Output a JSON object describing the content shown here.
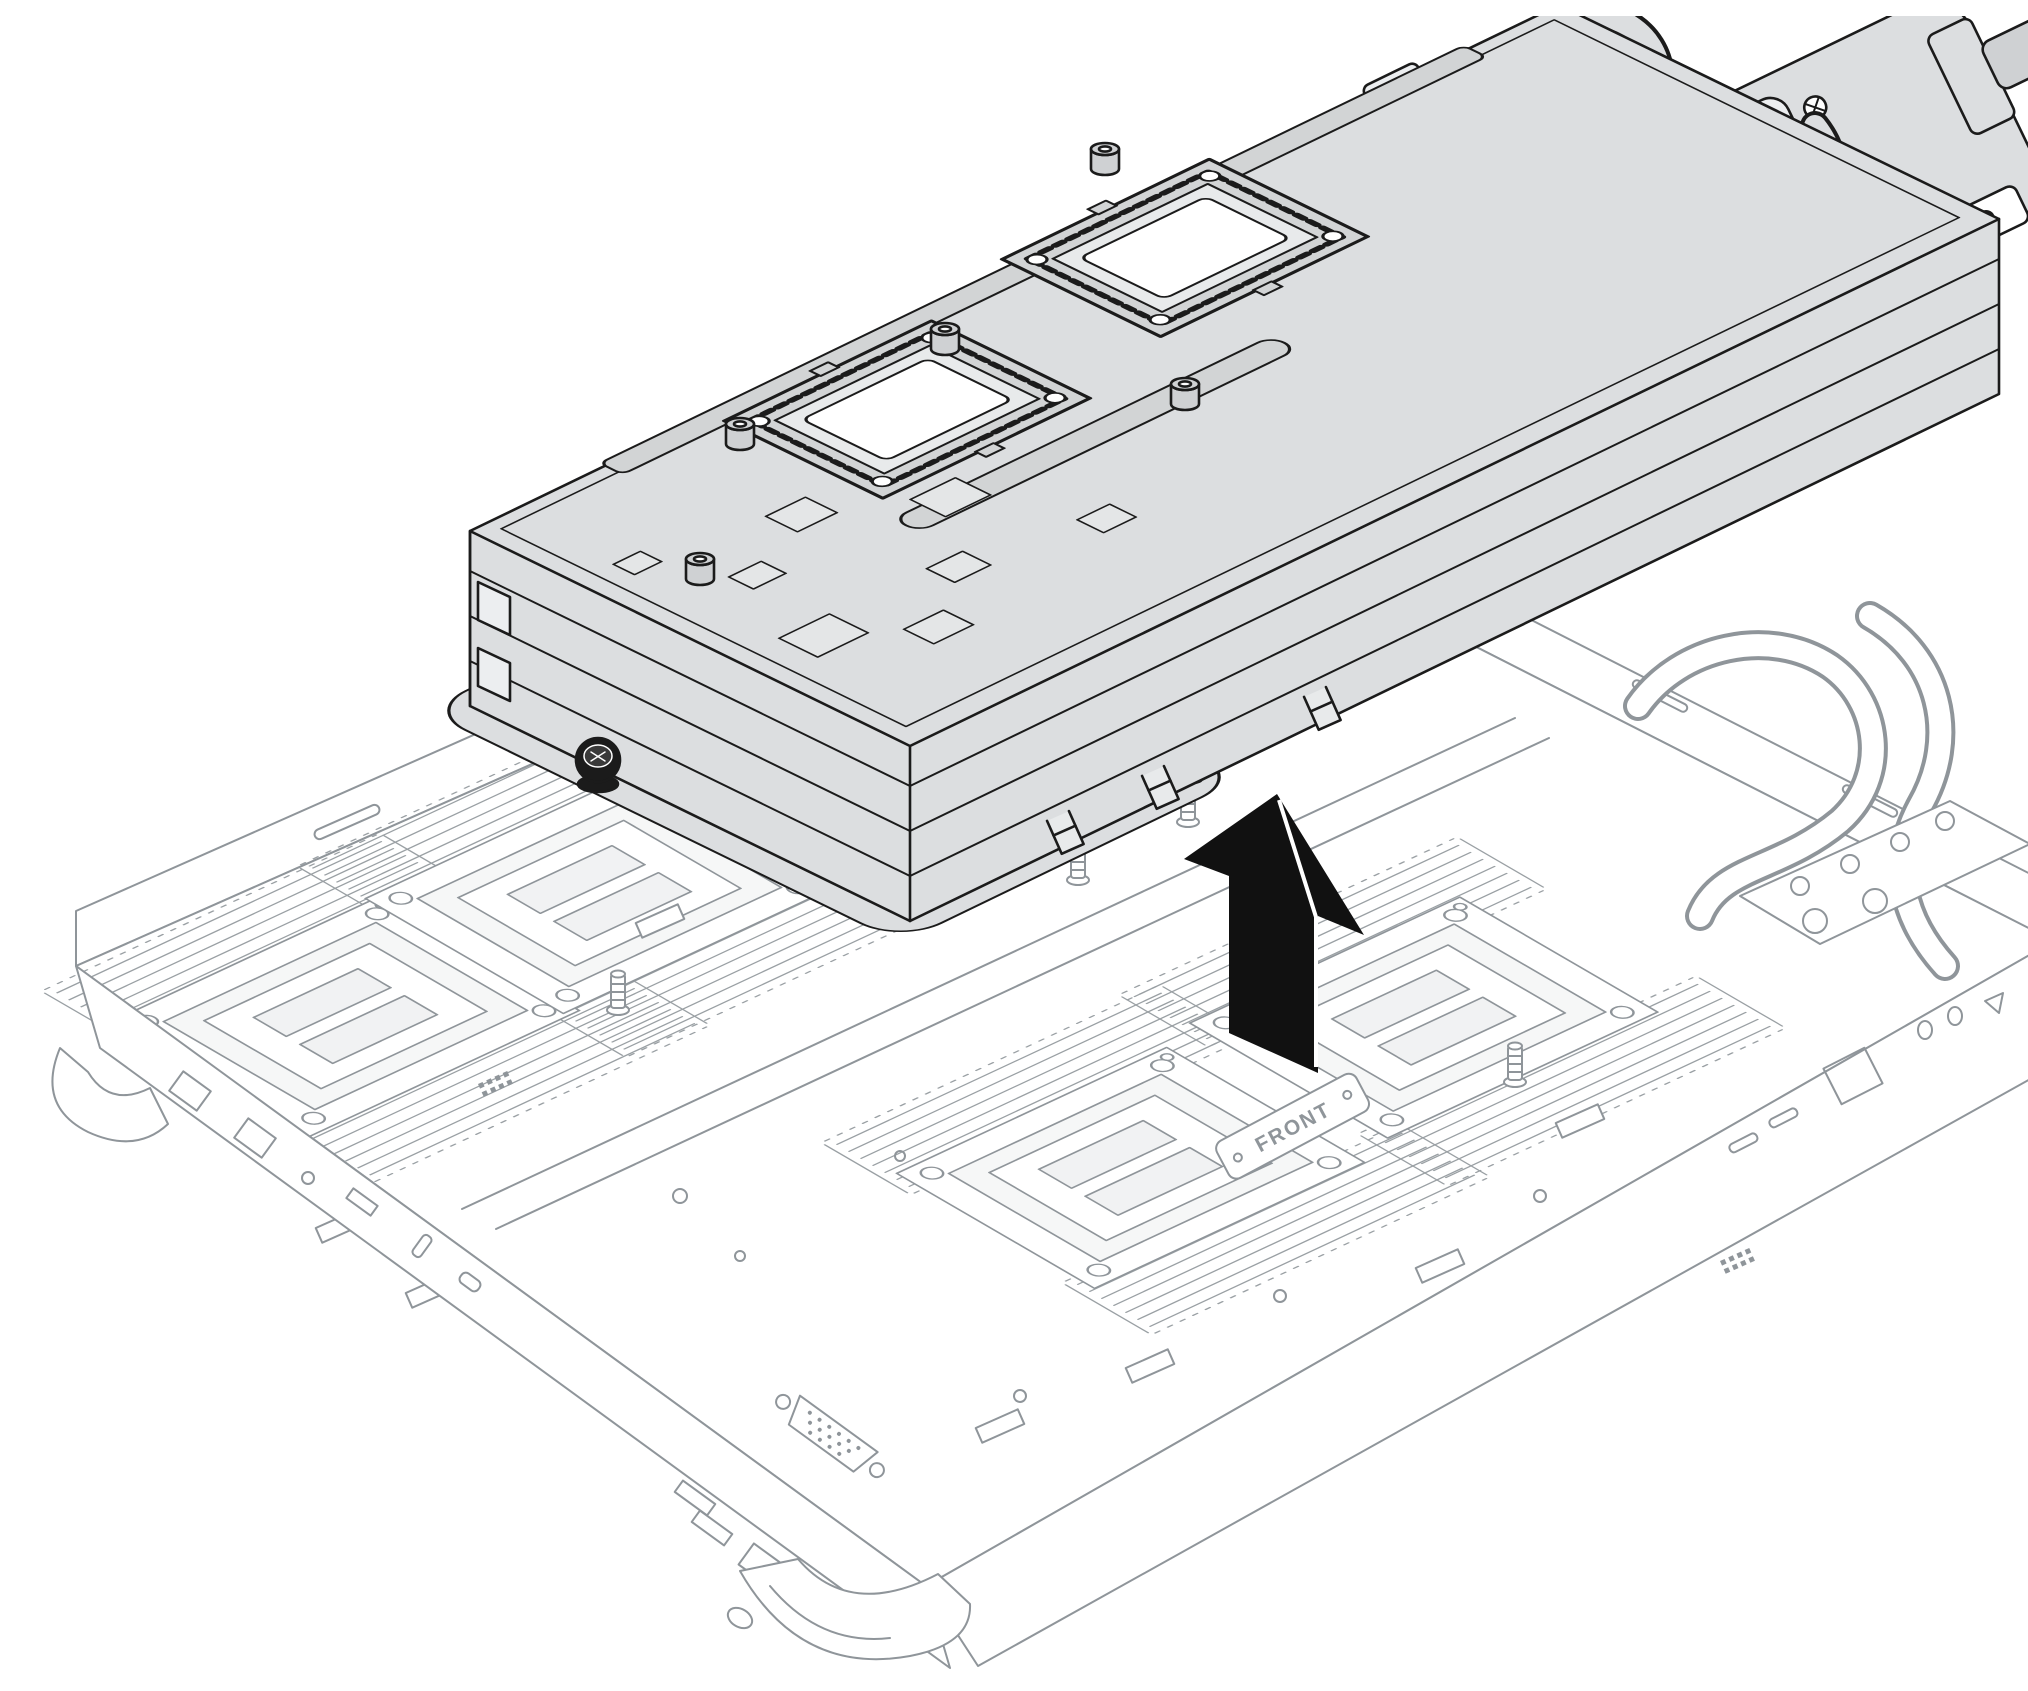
{
  "figure": {
    "board_label": "FRONT",
    "lift_arrow": {
      "direction": "up"
    },
    "colors": {
      "background": "#ffffff",
      "tray_line": "#8f959a",
      "assembly_line": "#1b1b1b",
      "assembly_fill": "#dcdee0",
      "arrow_fill": "#111111"
    }
  }
}
